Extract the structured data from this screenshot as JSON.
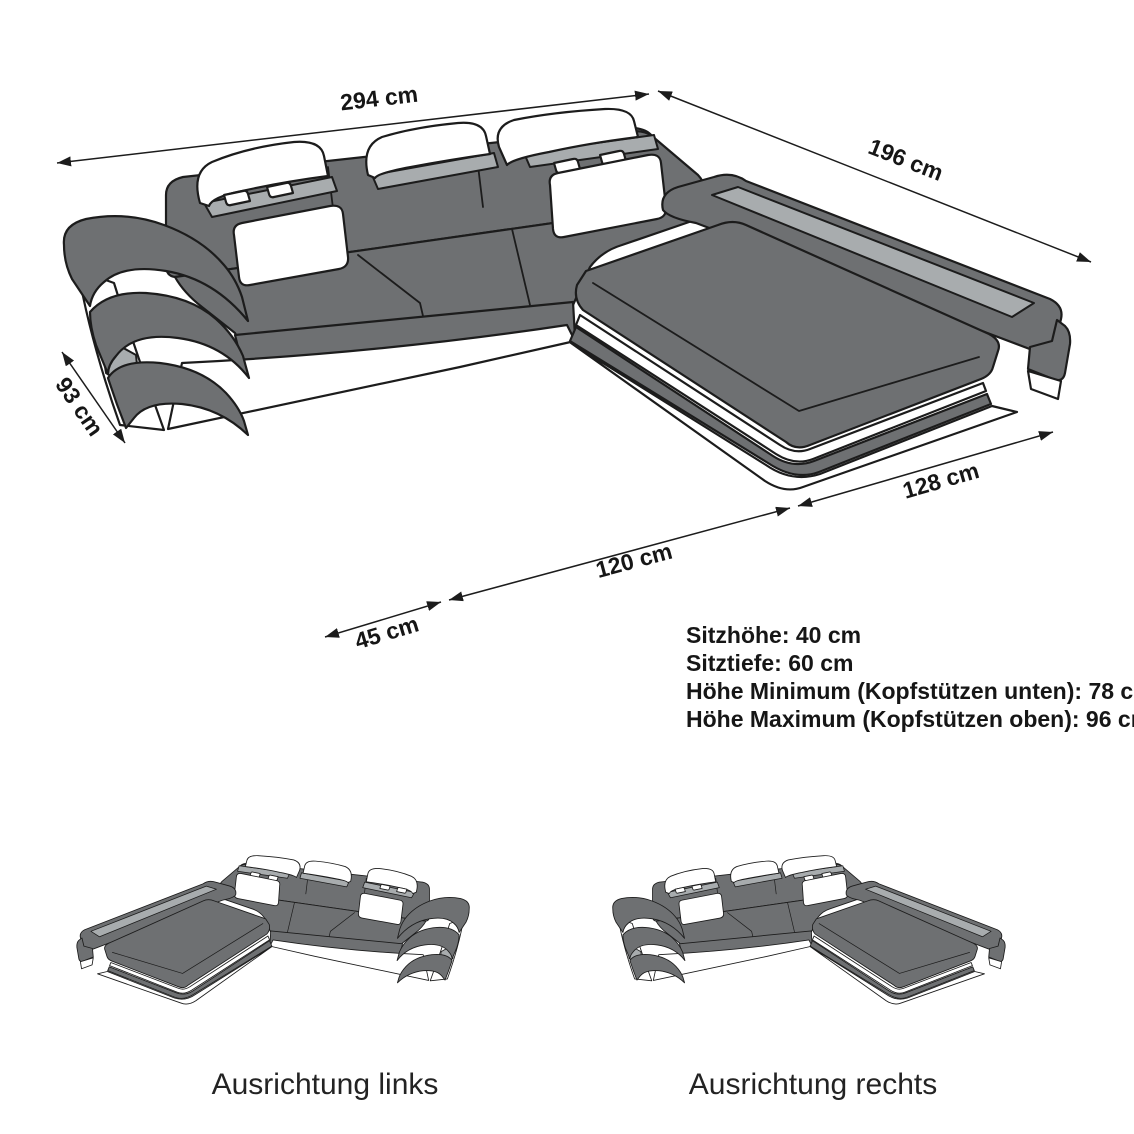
{
  "colors": {
    "body": "#6e7072",
    "light": "#a8acae",
    "outline": "#1c1c1c",
    "text": "#161616",
    "background": "#ffffff"
  },
  "main_diagram": {
    "dimensions": {
      "total_width": "294 cm",
      "chaise_side": "196 cm",
      "left_side_depth": "93 cm",
      "front_armrest": "45 cm",
      "front_seat": "120 cm",
      "front_chaise": "128 cm"
    },
    "specs": [
      "Sitzhöhe: 40 cm",
      "Sitztiefe: 60 cm",
      "Höhe Minimum (Kopfstützen unten): 78 cm",
      "Höhe Maximum (Kopfstützen oben): 96 cm"
    ]
  },
  "variants": {
    "left_caption": "Ausrichtung links",
    "right_caption": "Ausrichtung rechts"
  }
}
